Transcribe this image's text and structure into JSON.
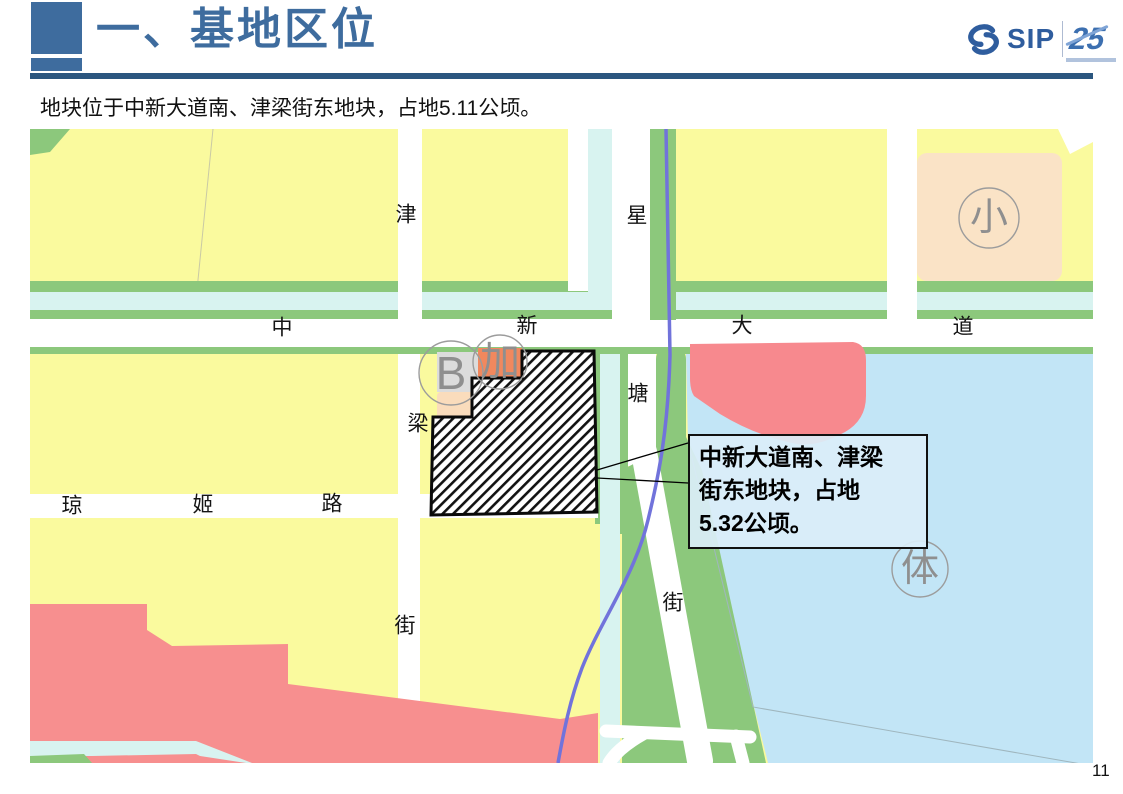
{
  "page": {
    "title": "一、基地区位",
    "subtitle": "地块位于中新大道南、津梁街东地块，占地5.11公顷。",
    "page_number": "11"
  },
  "logo": {
    "sip": "SIP",
    "anniversary": "25"
  },
  "map": {
    "road_labels": [
      {
        "text": "津",
        "x": 406,
        "y": 215
      },
      {
        "text": "梁",
        "x": 418,
        "y": 424
      },
      {
        "text": "街",
        "x": 405,
        "y": 626
      },
      {
        "text": "星",
        "x": 637,
        "y": 216
      },
      {
        "text": "塘",
        "x": 638,
        "y": 394
      },
      {
        "text": "街",
        "x": 673,
        "y": 603
      },
      {
        "text": "中",
        "x": 282,
        "y": 328
      },
      {
        "text": "新",
        "x": 527,
        "y": 326
      },
      {
        "text": "大",
        "x": 742,
        "y": 326
      },
      {
        "text": "道",
        "x": 963,
        "y": 327
      },
      {
        "text": "琼",
        "x": 72,
        "y": 506
      },
      {
        "text": "姬",
        "x": 203,
        "y": 505
      },
      {
        "text": "路",
        "x": 332,
        "y": 504
      }
    ],
    "area_labels": [
      {
        "text": "B",
        "x": 451,
        "y": 373,
        "r": 32,
        "size": 46
      },
      {
        "text": "加",
        "x": 500,
        "y": 362,
        "r": 27,
        "size": 40
      },
      {
        "text": "小",
        "x": 989,
        "y": 218,
        "r": 30,
        "size": 38
      },
      {
        "text": "体",
        "x": 920,
        "y": 569,
        "r": 28,
        "size": 38
      }
    ],
    "callout": {
      "lines": [
        "中新大道南、津梁",
        "街东地块，占地",
        "5.32公顷。"
      ]
    }
  },
  "colors": {
    "accent": "#3E6C9E",
    "rule": "#2B567F",
    "yellow": "#FAFA9E",
    "green": "#8CC87C",
    "canal": "#D8F3F0",
    "water": "#C2E5F6",
    "pink": "#F7898E",
    "pink_large": "#F78F8F",
    "orange": "#F1885E",
    "peach": "#FADCBC",
    "peach_light": "#FAE3C6",
    "gray_parcel": "#DCDCDC",
    "purple": "#7173DB"
  }
}
